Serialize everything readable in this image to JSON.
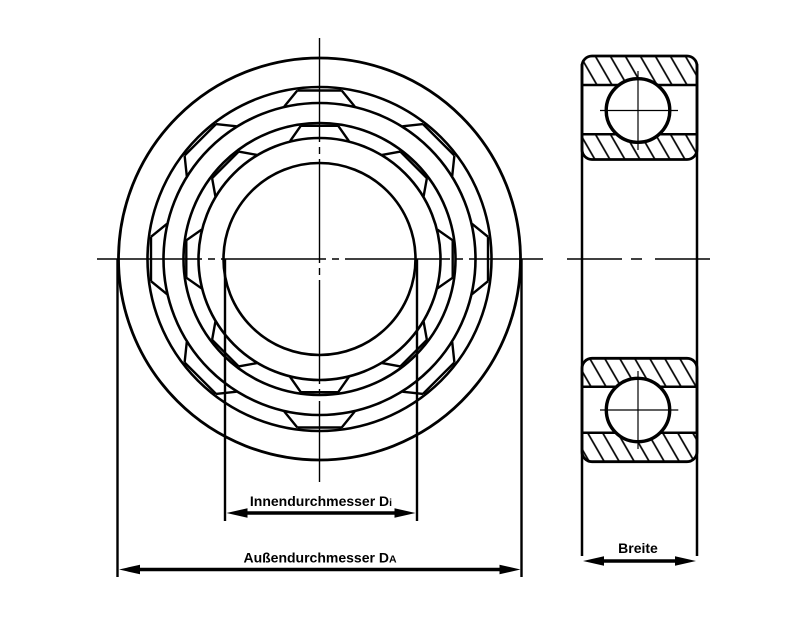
{
  "drawing": {
    "background_color": "#ffffff",
    "line_color": "#000000",
    "dimensions": {
      "inner_diameter": {
        "label": "Innendurchmesser D",
        "subscript": "i"
      },
      "outer_diameter": {
        "label": "Außendurchmesser D",
        "subscript": "A"
      },
      "width": {
        "label": "Breite"
      }
    }
  }
}
